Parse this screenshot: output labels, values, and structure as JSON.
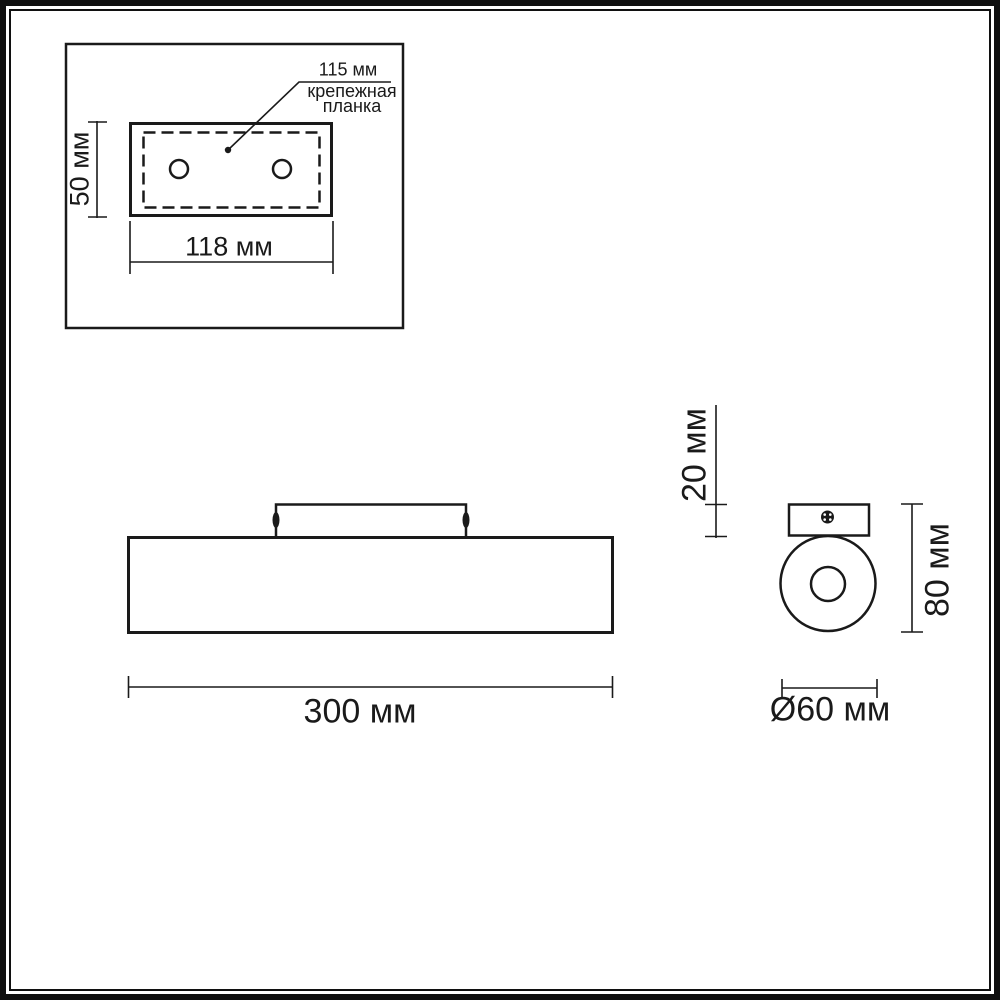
{
  "colors": {
    "line": "#1a1a1a",
    "background": "#ffffff",
    "frame": "#101010"
  },
  "views": {
    "mounting_plate_detail": {
      "callout_dimension": "115 мм",
      "callout_label_line1": "крепежная",
      "callout_label_line2": "планка",
      "height_dimension": "50 мм",
      "width_dimension": "118 мм"
    },
    "front_view": {
      "width_dimension": "300 мм"
    },
    "side_view": {
      "plate_height_dimension": "20 мм",
      "total_height_dimension": "80 мм",
      "diameter_dimension": "Ø60 мм"
    }
  }
}
